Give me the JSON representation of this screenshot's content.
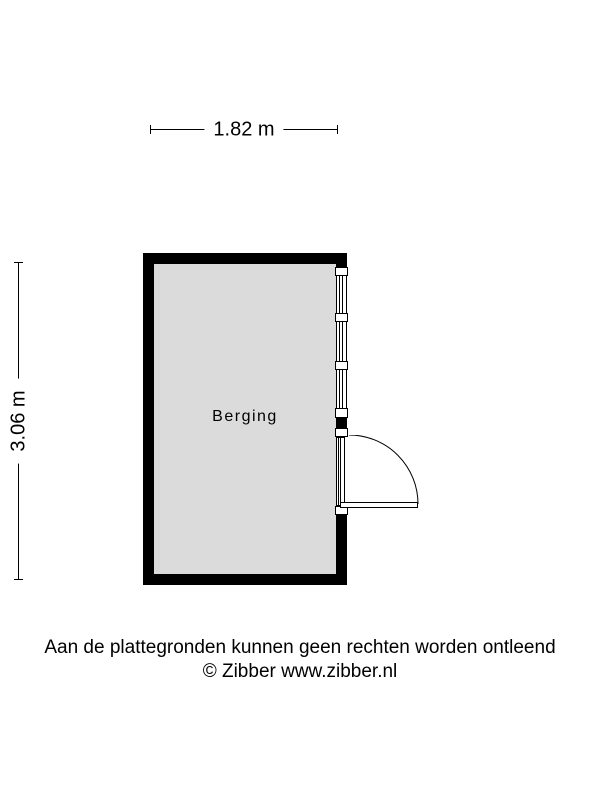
{
  "colors": {
    "wall": "#000000",
    "floor": "#dbdbdb",
    "background": "#ffffff",
    "line": "#000000"
  },
  "dimensions": {
    "width_label": "1.82 m",
    "height_label": "3.06 m"
  },
  "room": {
    "label": "Berging"
  },
  "footer": {
    "disclaimer": "Aan de plattegronden kunnen geen rechten worden ontleend",
    "copyright": "© Zibber www.zibber.nl"
  }
}
